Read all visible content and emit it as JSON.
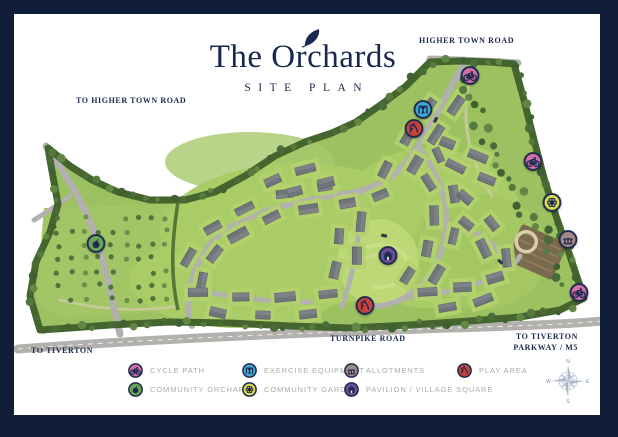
{
  "title": {
    "main": "The Orchards",
    "subtitle": "SITE PLAN"
  },
  "road_labels": {
    "higher_town_road": "HIGHER TOWN ROAD",
    "to_higher_town_road": "TO HIGHER TOWN ROAD",
    "to_tiverton": "TO TIVERTON",
    "turnpike_road": "TURNPIKE ROAD",
    "to_tiverton_parkway_line1": "TO TIVERTON",
    "to_tiverton_parkway_line2": "PARKWAY / M5"
  },
  "legend": {
    "items": [
      {
        "label": "CYCLE PATH",
        "icon": "cycle-path-icon",
        "color": "#d06ea6"
      },
      {
        "label": "EXERCISE EQUIPMENT",
        "icon": "exercise-equipment-icon",
        "color": "#3fa8d8"
      },
      {
        "label": "ALLOTMENTS",
        "icon": "allotments-icon",
        "color": "#a38a85"
      },
      {
        "label": "PLAY AREA",
        "icon": "play-area-icon",
        "color": "#c8423b"
      },
      {
        "label": "COMMUNITY ORCHARD",
        "icon": "community-orchard-icon",
        "color": "#69a557"
      },
      {
        "label": "COMMUNITY GARDEN",
        "icon": "community-garden-icon",
        "color": "#dcdb52"
      },
      {
        "label": "PAVILION / VILLAGE SQUARE",
        "icon": "pavilion-village-square-icon",
        "color": "#6a4e96"
      }
    ]
  },
  "map_markers": [
    {
      "icon": "cycle-path-icon",
      "x": 470,
      "y": 78
    },
    {
      "icon": "exercise-equipment-icon",
      "x": 423,
      "y": 112
    },
    {
      "icon": "play-area-icon",
      "x": 414,
      "y": 131
    },
    {
      "icon": "cycle-path-icon",
      "x": 533,
      "y": 164
    },
    {
      "icon": "community-garden-icon",
      "x": 552,
      "y": 205
    },
    {
      "icon": "allotments-icon",
      "x": 568,
      "y": 242
    },
    {
      "icon": "cycle-path-icon",
      "x": 579,
      "y": 295
    },
    {
      "icon": "community-orchard-icon",
      "x": 96,
      "y": 246
    },
    {
      "icon": "pavilion-village-square-icon",
      "x": 388,
      "y": 258
    },
    {
      "icon": "play-area-icon",
      "x": 365,
      "y": 308
    }
  ],
  "compass": {
    "n": "N",
    "e": "E",
    "s": "S",
    "w": "W"
  },
  "colors": {
    "frame": "#101e3a",
    "ink": "#1d2b4f",
    "site_green": "#9cc161",
    "hedge": "#44652e",
    "road": "#b2b1ad"
  }
}
